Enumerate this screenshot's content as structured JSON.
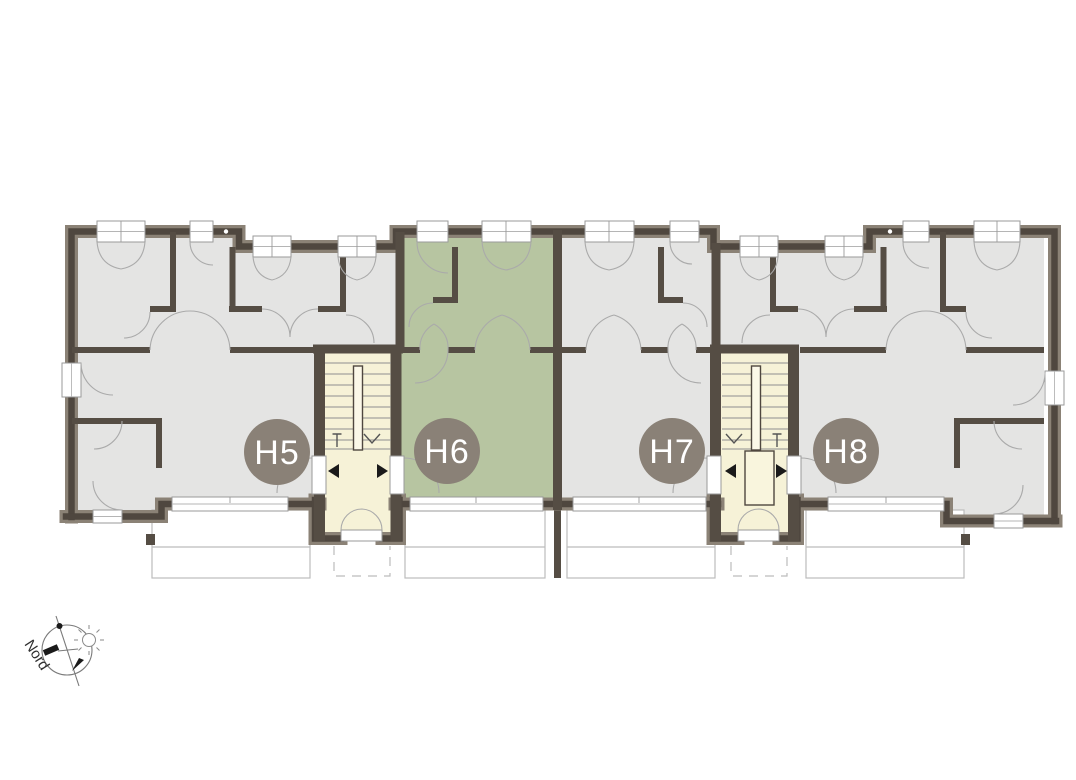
{
  "floor_plan": {
    "units": [
      {
        "label": "H5",
        "highlighted": false
      },
      {
        "label": "H6",
        "highlighted": true
      },
      {
        "label": "H7",
        "highlighted": false
      },
      {
        "label": "H8",
        "highlighted": false
      }
    ],
    "highlighted_unit": "H6",
    "compass_label": "Nord",
    "colors": {
      "unit_default": "#e4e4e3",
      "unit_highlighted": "#b7c5a1",
      "stairwell": "#f6f2d7",
      "wall_dark": "#4f473f",
      "wall_light": "#8b8276",
      "label_circle": "#8a8177",
      "label_text": "#ffffff"
    }
  }
}
